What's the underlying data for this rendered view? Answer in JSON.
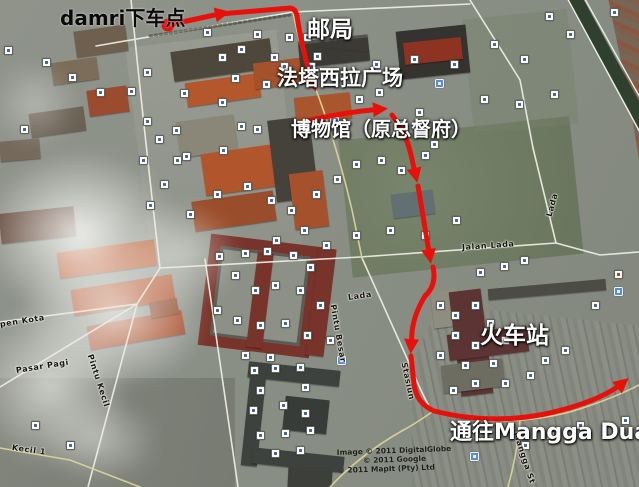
{
  "map": {
    "annotations": {
      "damri": "damri下车点",
      "post_office": "邮局",
      "square": "法塔西拉广场",
      "museum": "博物馆（原总督府）",
      "station": "火车站",
      "mangga_dua": "通往Mangga Dua"
    },
    "road_labels": [
      {
        "text": "Jalan Lada",
        "x": 462,
        "y": 243,
        "rot": -4
      },
      {
        "text": "Lada",
        "x": 549,
        "y": 212,
        "rot": -75
      },
      {
        "text": "Lada",
        "x": 348,
        "y": 293,
        "rot": -8
      },
      {
        "text": "Pintu Besar",
        "x": 333,
        "y": 300,
        "rot": 80
      },
      {
        "text": "Pasar Pagi",
        "x": 16,
        "y": 366,
        "rot": -9
      },
      {
        "text": "pen Kota",
        "x": 0,
        "y": 320,
        "rot": -9
      },
      {
        "text": "Pintu Kecil",
        "x": 90,
        "y": 350,
        "rot": 72
      },
      {
        "text": "Kecil 1",
        "x": 12,
        "y": 443,
        "rot": 8
      },
      {
        "text": "Stasiun",
        "x": 404,
        "y": 358,
        "rot": 78
      },
      {
        "text": "Mangga St",
        "x": 516,
        "y": 428,
        "rot": 72
      }
    ],
    "attribution": {
      "line1": "Image © 2011 DigitalGlobe",
      "line2": "© 2011 Google",
      "line3": "© 2011 MapIt (Pty) Ltd"
    },
    "route_color": "#e8100a",
    "markers": {
      "white": [
        [
          4,
          46
        ],
        [
          20,
          125
        ],
        [
          42,
          58
        ],
        [
          68,
          73
        ],
        [
          96,
          88
        ],
        [
          127,
          87
        ],
        [
          143,
          117
        ],
        [
          155,
          135
        ],
        [
          172,
          126
        ],
        [
          180,
          89
        ],
        [
          143,
          68
        ],
        [
          203,
          28
        ],
        [
          218,
          53
        ],
        [
          237,
          45
        ],
        [
          253,
          30
        ],
        [
          270,
          53
        ],
        [
          280,
          62
        ],
        [
          303,
          33
        ],
        [
          285,
          33
        ],
        [
          313,
          52
        ],
        [
          218,
          98
        ],
        [
          253,
          125
        ],
        [
          237,
          122
        ],
        [
          219,
          146
        ],
        [
          182,
          152
        ],
        [
          173,
          156
        ],
        [
          139,
          156
        ],
        [
          307,
          62
        ],
        [
          262,
          80
        ],
        [
          231,
          74
        ],
        [
          160,
          180
        ],
        [
          146,
          201
        ],
        [
          186,
          210
        ],
        [
          213,
          190
        ],
        [
          243,
          182
        ],
        [
          267,
          196
        ],
        [
          287,
          206
        ],
        [
          312,
          190
        ],
        [
          333,
          175
        ],
        [
          352,
          160
        ],
        [
          377,
          156
        ],
        [
          397,
          166
        ],
        [
          421,
          151
        ],
        [
          300,
          226
        ],
        [
          272,
          236
        ],
        [
          322,
          241
        ],
        [
          352,
          231
        ],
        [
          386,
          226
        ],
        [
          421,
          231
        ],
        [
          452,
          216
        ],
        [
          476,
          268
        ],
        [
          500,
          262
        ],
        [
          520,
          256
        ],
        [
          545,
          12
        ],
        [
          610,
          8
        ],
        [
          566,
          30
        ],
        [
          215,
          252
        ],
        [
          241,
          249
        ],
        [
          263,
          247
        ],
        [
          289,
          251
        ],
        [
          306,
          263
        ],
        [
          231,
          271
        ],
        [
          251,
          286
        ],
        [
          271,
          281
        ],
        [
          296,
          286
        ],
        [
          316,
          301
        ],
        [
          213,
          306
        ],
        [
          233,
          316
        ],
        [
          256,
          321
        ],
        [
          281,
          319
        ],
        [
          303,
          331
        ],
        [
          326,
          336
        ],
        [
          241,
          351
        ],
        [
          266,
          353
        ],
        [
          250,
          366
        ],
        [
          271,
          364
        ],
        [
          296,
          363
        ],
        [
          256,
          386
        ],
        [
          301,
          383
        ],
        [
          249,
          406
        ],
        [
          279,
          401
        ],
        [
          301,
          409
        ],
        [
          256,
          431
        ],
        [
          281,
          429
        ],
        [
          306,
          426
        ],
        [
          271,
          449
        ],
        [
          296,
          446
        ],
        [
          436,
          301
        ],
        [
          451,
          311
        ],
        [
          471,
          301
        ],
        [
          486,
          319
        ],
        [
          451,
          331
        ],
        [
          471,
          341
        ],
        [
          501,
          336
        ],
        [
          436,
          351
        ],
        [
          461,
          361
        ],
        [
          489,
          359
        ],
        [
          471,
          379
        ],
        [
          449,
          386
        ],
        [
          501,
          379
        ],
        [
          526,
          371
        ],
        [
          541,
          356
        ],
        [
          561,
          346
        ],
        [
          591,
          301
        ],
        [
          576,
          421
        ],
        [
          546,
          431
        ],
        [
          521,
          441
        ],
        [
          621,
          416
        ],
        [
          31,
          421
        ],
        [
          66,
          441
        ],
        [
          355,
          95
        ],
        [
          375,
          88
        ],
        [
          395,
          120
        ],
        [
          415,
          108
        ],
        [
          430,
          140
        ],
        [
          372,
          60
        ],
        [
          410,
          55
        ],
        [
          450,
          60
        ],
        [
          490,
          40
        ],
        [
          520,
          55
        ],
        [
          480,
          95
        ],
        [
          515,
          100
        ],
        [
          550,
          90
        ]
      ],
      "blue": [
        [
          330,
          117
        ],
        [
          435,
          79
        ],
        [
          337,
          356
        ],
        [
          614,
          287
        ],
        [
          470,
          452
        ]
      ],
      "red": [
        [
          614,
          270
        ]
      ]
    }
  }
}
